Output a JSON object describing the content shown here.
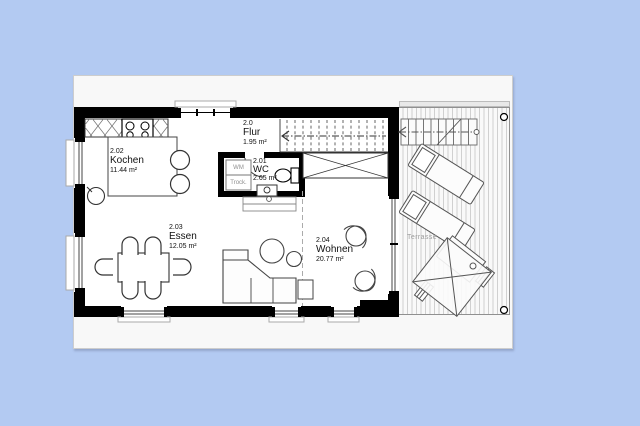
{
  "floorplan": {
    "rooms": {
      "flur": {
        "number": "2.0",
        "name": "Flur",
        "area": "1.95 m²"
      },
      "wc": {
        "number": "2.01",
        "name": "WC",
        "area": "2.65 m²"
      },
      "kochen": {
        "number": "2.02",
        "name": "Kochen",
        "area": "11.44 m²"
      },
      "essen": {
        "number": "2.03",
        "name": "Essen",
        "area": "12.05 m²"
      },
      "wohnen": {
        "number": "2.04",
        "name": "Wohnen",
        "area": "20.77 m²"
      }
    },
    "appliances": {
      "washing_machine": "WM",
      "dryer": "Trock."
    },
    "outdoor": {
      "terrace": "Terrasse"
    },
    "symbols": [
      "stove-symbol",
      "kitchen-sink-symbol",
      "bar-stool-symbol",
      "toilet-symbol",
      "wc-sink-symbol",
      "interior-stairs-symbol",
      "exterior-stairs-symbol",
      "wardrobe-cross-symbol",
      "dining-table-symbol",
      "chair-symbol",
      "sofa-symbol",
      "coffee-table-symbol",
      "armchair-symbol",
      "sun-lounger-symbol",
      "parasol-table-symbol",
      "terrace-post-symbol"
    ]
  },
  "colors": {
    "background": "#b3caf2",
    "panel": "#f8f8f8",
    "panel_border": "#cdcdcd",
    "wall": "#000000",
    "furniture_line": "#3c3c3c",
    "light_line": "#8a8a8a",
    "deck_stripe": "#d0d0d0",
    "muted_text": "#9c9c9c"
  }
}
